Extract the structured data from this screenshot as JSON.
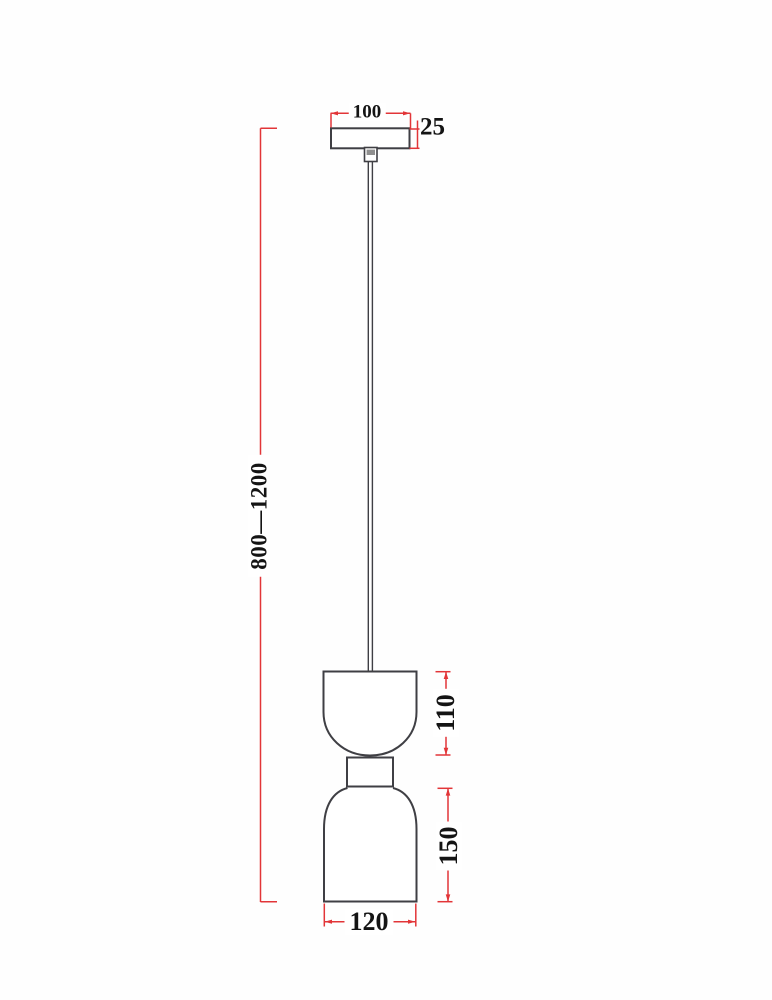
{
  "drawing": {
    "labels": {
      "canopy_width": "100",
      "canopy_height": "25",
      "cable_length": "800—1200",
      "upper_shade_height": "110",
      "lower_shade_height": "150",
      "shade_diameter": "120"
    },
    "colors": {
      "dimension_red": "#e23538",
      "outline_gray": "#3f3f44",
      "label_black": "#141414",
      "background": "#fefefe"
    }
  }
}
